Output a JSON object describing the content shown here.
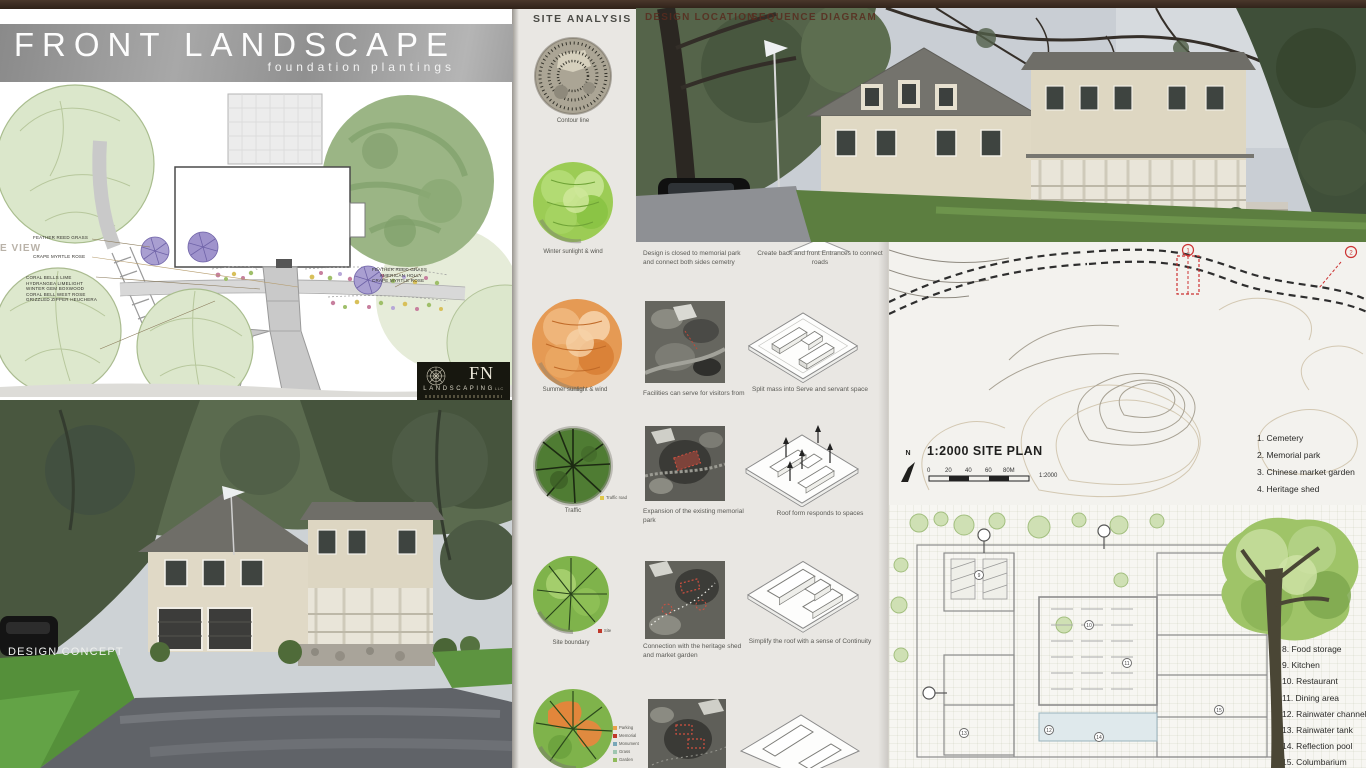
{
  "colors": {
    "top_bar": "#3a2b20",
    "banner_grey": "#9a9a9a",
    "accent_green": "#8cc63f",
    "accent_orange": "#e59a54",
    "board_bg": "#e9e7e3",
    "red_marker": "#cc3333",
    "lawn_green": "#5c8f3c"
  },
  "front_landscape": {
    "title": "FRONT LANDSCAPE",
    "subtitle": "foundation plantings",
    "edge_label": "E VIEW",
    "labels_left": [
      "FEATHER REED GRASS",
      "CRAPE MYRTLE ROSE"
    ],
    "labels_bed": [
      "CORAL BELLS LIME",
      "HYDRANGEA LIMELIGHT",
      "WINTER GEM BOXWOOD",
      "CORAL BELL WEST ROSE",
      "GRIZZLED ZIPPER HEUCHERA"
    ],
    "labels_right": [
      "FEATHER REED GRASS",
      "AMERICAN HOLLY",
      "CRAPE MYRTLE ROSE"
    ],
    "logo": {
      "monogram": "FN",
      "name": "LANDSCAPING",
      "suffix": "LLC"
    }
  },
  "design_concept": {
    "label": "DESIGN CONCEPT"
  },
  "photo_overlay": {
    "label_left": "DESIGN LOCATION",
    "label_right": "SEQUENCE DIAGRAM"
  },
  "site_analysis": {
    "title": "SITE ANALYSIS",
    "circles": [
      {
        "label": "Contour line"
      },
      {
        "label": "Winter sunlight & wind"
      },
      {
        "label": "Summer sunlight & wind"
      },
      {
        "label": "Traffic",
        "legend": [
          {
            "label": "Traffic road",
            "color": "#e0c84a"
          }
        ]
      },
      {
        "label": "Site boundary",
        "legend": [
          {
            "label": "Site",
            "color": "#c0392b"
          }
        ]
      },
      {
        "label": "",
        "legend": [
          {
            "label": "Parking",
            "color": "#e8a24a"
          },
          {
            "label": "Memorial",
            "color": "#c0392b"
          },
          {
            "label": "Monument",
            "color": "#7aa7b8"
          },
          {
            "label": "Grass",
            "color": "#9fc6b0"
          },
          {
            "label": "Garden",
            "color": "#8fba5a"
          }
        ]
      }
    ],
    "photo_captions": [
      "Design is closed to memorial park and connect both sides cemetry",
      "Facilities can serve for visitors from",
      "Expansion of the existing memorial park",
      "Connection with the heritage shed and market garden"
    ],
    "diagram_captions": [
      "Create back and front Entrances to connect roads",
      "Split mass into Serve and servant space",
      "Roof form responds to spaces",
      "Simplify the roof with a sense of Continuity"
    ]
  },
  "site_plan": {
    "title": "1:2000 SITE PLAN",
    "north": "N",
    "scale_ticks": [
      "0",
      "20",
      "40",
      "60",
      "80M"
    ],
    "scale_ratio": "1:2000",
    "markers": [
      "1",
      "2"
    ],
    "legend": [
      "1. Cemetery",
      "2. Memorial park",
      "3. Chinese market garden",
      "4. Heritage shed"
    ]
  },
  "floor_plan": {
    "markers": [
      "9",
      "10",
      "11",
      "12",
      "13",
      "14",
      "15"
    ],
    "legend": [
      "8. Food storage",
      "9. Kitchen",
      "10. Restaurant",
      "11. Dining area",
      "12. Rainwater channel",
      "13. Rainwater tank",
      "14. Reflection pool",
      "15. Columbarium"
    ]
  }
}
